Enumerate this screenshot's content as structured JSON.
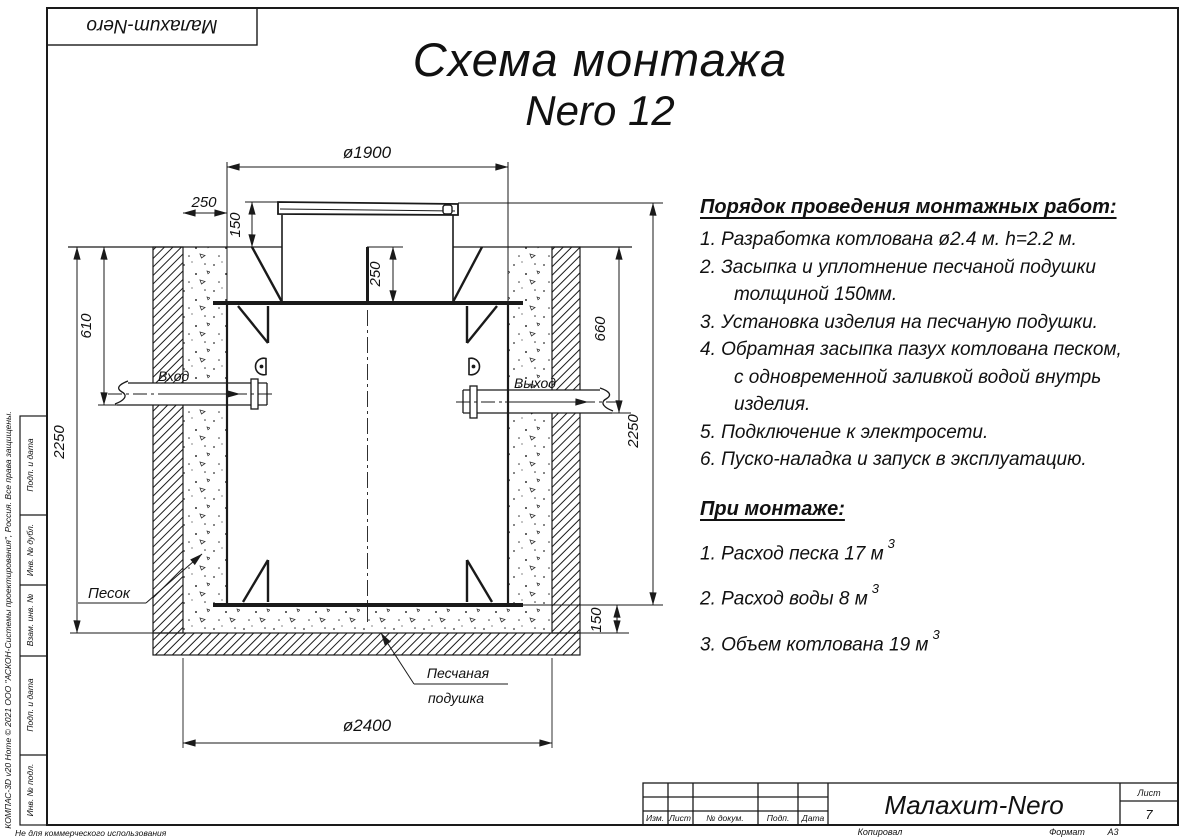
{
  "sheet": {
    "logo": "Малахит-Nero",
    "side": {
      "kompas_line": "КОМПАС-3D v20 Home © 2021 ООО \"АСКОН-Системы проектирования\", Россия. Все права защищены.",
      "cells": [
        "Подп. и дата",
        "Инв. № дубл.",
        "Взам. инв. №",
        "Подп. и дата",
        "Инв. № подл."
      ],
      "non_commercial": "Не для коммерческого использования"
    },
    "title_block": {
      "cols": [
        "Изм.",
        "Лист",
        "№ докум.",
        "Подп.",
        "Дата"
      ],
      "product": "Малахит-Nero",
      "sheet_label": "Лист",
      "sheet_number": "7",
      "copied": "Копировал",
      "format_label": "Формат",
      "format_value": "А3"
    }
  },
  "title": {
    "line1": "Схема монтажа",
    "line2": "Nero 12"
  },
  "drawing": {
    "dims": {
      "tank_diameter": "ø1900",
      "side_gap": "250",
      "lid_height": "150",
      "neck_height": "250",
      "inlet_depth": "610",
      "left_total": "2250",
      "outlet_depth": "660",
      "right_total": "2250",
      "cushion_height": "150",
      "pit_diameter": "ø2400"
    },
    "labels": {
      "inlet": "Вход",
      "outlet": "Выход",
      "sand": "Песок",
      "cushion1": "Песчаная",
      "cushion2": "подушка"
    }
  },
  "procedure": {
    "heading": "Порядок проведения монтажных работ:",
    "lines": [
      {
        "text": "1. Разработка котлована ø2.4 м. h=2.2 м."
      },
      {
        "text": "2. Засыпка и уплотнение песчаной подушки"
      },
      {
        "text": "толщиной 150мм."
      },
      {
        "text": "3. Установка изделия на песчаную подушки."
      },
      {
        "text": "4. Обратная засыпка пазух котлована песком,"
      },
      {
        "text": "с одновременной заливкой водой внутрь"
      },
      {
        "text": "изделия."
      },
      {
        "text": "5. Подключение к электросети."
      },
      {
        "text": "6. Пуско-наладка и запуск в эксплуатацию."
      }
    ]
  },
  "montage": {
    "heading": "При монтаже:",
    "items": [
      {
        "text": "1. Расход песка 17 м",
        "sup": "3"
      },
      {
        "text": "2. Расход воды 8 м",
        "sup": "3"
      },
      {
        "text": "3. Объем котлована 19 м",
        "sup": "3"
      }
    ]
  }
}
